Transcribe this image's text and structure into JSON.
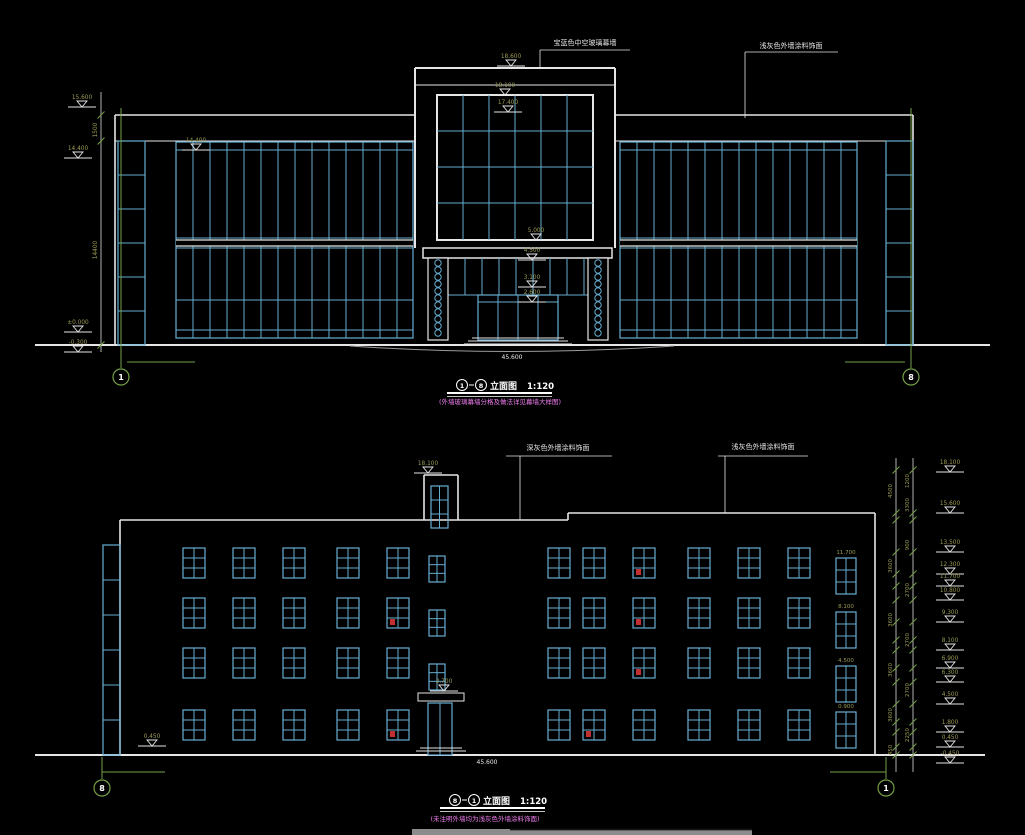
{
  "document": {
    "type": "CAD building elevation sheet",
    "background": "#000000"
  },
  "colors": {
    "outline": "#e6e6e6",
    "glazing": "#66aed0",
    "axis_green": "#76a047",
    "dimension_text": "#9c9c55",
    "note_magenta": "#f07df0",
    "red_mark": "#c03030",
    "gray_bar": "#8c8c8c"
  },
  "top_elevation": {
    "title": {
      "from": "1",
      "to": "8",
      "label": "立面图",
      "scale": "1:120"
    },
    "note": "(外墙玻璃幕墙分格及做法详见幕墙大样图)",
    "annotation_left": "宝蓝色中空玻璃幕墙",
    "annotation_right": "浅灰色外墙涂料饰面",
    "grid_bubble_left": "1",
    "grid_bubble_right": "8",
    "overall_width": "45.600",
    "levels_left": [
      "15.600",
      "14.400",
      "±0.000",
      "-0.300"
    ],
    "level_wing": "14.400",
    "levels_center": [
      "18.600",
      "18.100",
      "17.400",
      "5.000",
      "4.500",
      "3.100",
      "2.600"
    ],
    "dims_left": [
      "1500",
      "14400"
    ]
  },
  "bottom_elevation": {
    "title": {
      "from": "8",
      "to": "1",
      "label": "立面图",
      "scale": "1:120"
    },
    "note": "(未注明外墙均为浅灰色外墙涂料饰面)",
    "annotation_left": "深灰色外墙涂料饰面",
    "annotation_right": "浅灰色外墙涂料饰面",
    "grid_bubble_left": "8",
    "grid_bubble_right": "1",
    "overall_width": "45.600",
    "level_tower": "18.100",
    "level_door": "2.700",
    "level_base_left": "0.450",
    "stair_window_levels": [
      "11.700",
      "8.100",
      "4.500",
      "0.900"
    ],
    "levels_right": [
      "18.100",
      "15.600",
      "13.500",
      "12.300",
      "11.700",
      "10.800",
      "9.300",
      "8.100",
      "6.900",
      "6.300",
      "4.500",
      "1.800",
      "0.450",
      "-0.450"
    ],
    "dims_chain1": [
      "4500",
      "3600",
      "3600",
      "3600",
      "3600",
      "450"
    ],
    "dims_chain2": [
      "1200",
      "3300",
      "900",
      "2700",
      "2700",
      "2700",
      "2250"
    ]
  }
}
